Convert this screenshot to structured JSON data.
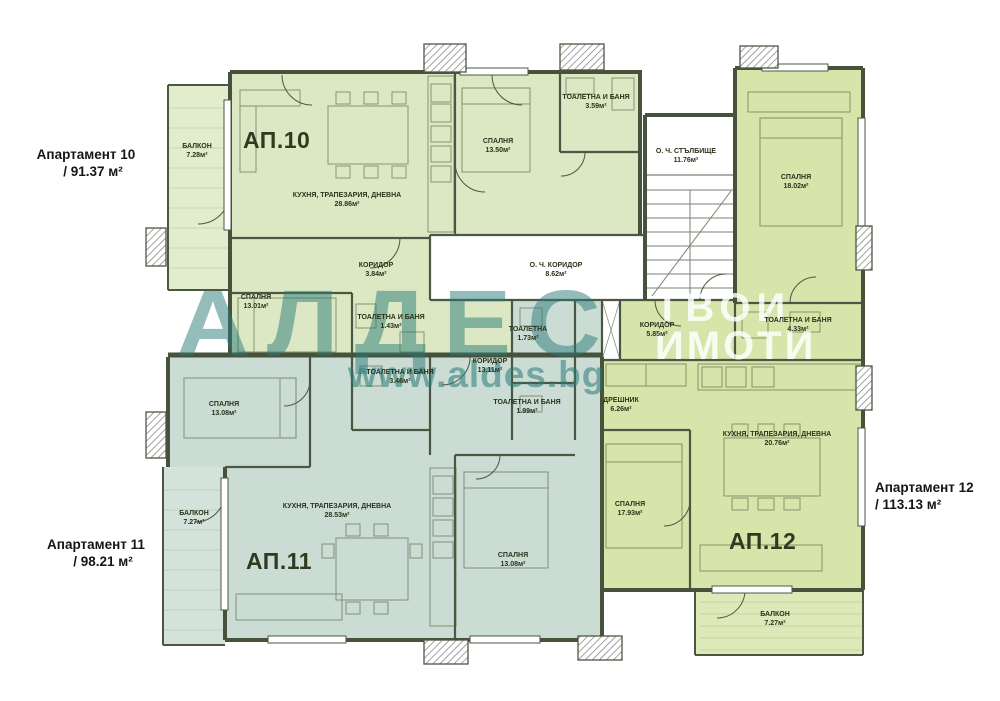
{
  "brand": {
    "logo_text": "АЛДЕС",
    "website": "www.aldes.bg",
    "tagline_line1": "ТВОИ",
    "tagline_line2": "ИМОТИ",
    "teal": "#2a7a78"
  },
  "apartments": [
    {
      "id": "ap10",
      "label": "Апартамент 10",
      "area": "/ 91.37 м²",
      "plan_label": "АП.10",
      "color": "#dbe8c3"
    },
    {
      "id": "ap11",
      "label": "Апартамент 11",
      "area": "/ 98.21 м²",
      "plan_label": "АП.11",
      "color": "#cbdcd4"
    },
    {
      "id": "ap12",
      "label": "Апартамент 12",
      "area": "/ 113.13 м²",
      "plan_label": "АП.12",
      "color": "#d7e5ab"
    }
  ],
  "rooms": [
    {
      "id": "balkon10",
      "apartment": "ap10",
      "name": "БАЛКОН",
      "area": "7.28м²"
    },
    {
      "id": "kitchen10",
      "apartment": "ap10",
      "name": "КУХНЯ, ТРАПЕЗАРИЯ, ДНЕВНА",
      "area": "28.86м²"
    },
    {
      "id": "koridor10",
      "apartment": "ap10",
      "name": "КОРИДОР",
      "area": "3.84м²"
    },
    {
      "id": "bedroom10a",
      "apartment": "ap10",
      "name": "СПАЛНЯ",
      "area": "13.50м²"
    },
    {
      "id": "bath10a",
      "apartment": "ap10",
      "name": "ТОАЛЕТНА И БАНЯ",
      "area": "3.59м²"
    },
    {
      "id": "bedroom10b",
      "apartment": "ap10",
      "name": "СПАЛНЯ",
      "area": "13.01м²"
    },
    {
      "id": "bath10b",
      "apartment": "ap10",
      "name": "ТОАЛЕТНА И БАНЯ",
      "area": "1.43м²"
    },
    {
      "id": "stairs",
      "apartment": "common",
      "name": "О. Ч. СТЪЛБИЩЕ",
      "area": "11.76м²"
    },
    {
      "id": "corridor_och",
      "apartment": "common",
      "name": "О. Ч. КОРИДОР",
      "area": "8.62м²"
    },
    {
      "id": "bedroom12a",
      "apartment": "ap12",
      "name": "СПАЛНЯ",
      "area": "18.02м²"
    },
    {
      "id": "bath12",
      "apartment": "ap12",
      "name": "ТОАЛЕТНА И БАНЯ",
      "area": "4.33м²"
    },
    {
      "id": "koridor12",
      "apartment": "ap12",
      "name": "КОРИДОР",
      "area": "5.85м²"
    },
    {
      "id": "dreshnik",
      "apartment": "ap12",
      "name": "ДРЕШНИК",
      "area": "6.26м²"
    },
    {
      "id": "kitchen12",
      "apartment": "ap12",
      "name": "КУХНЯ, ТРАПЕЗАРИЯ, ДНЕВНА",
      "area": "20.76м²"
    },
    {
      "id": "bedroom12b",
      "apartment": "ap12",
      "name": "СПАЛНЯ",
      "area": "17.93м²"
    },
    {
      "id": "balkon12",
      "apartment": "ap12",
      "name": "БАЛКОН",
      "area": "7.27м²"
    },
    {
      "id": "bedroom11a",
      "apartment": "ap11",
      "name": "СПАЛНЯ",
      "area": "13.08м²"
    },
    {
      "id": "balkon11",
      "apartment": "ap11",
      "name": "БАЛКОН",
      "area": "7.27м²"
    },
    {
      "id": "kitchen11",
      "apartment": "ap11",
      "name": "КУХНЯ, ТРАПЕЗАРИЯ, ДНЕВНА",
      "area": "28.53м²"
    },
    {
      "id": "bedroom11b",
      "apartment": "ap11",
      "name": "СПАЛНЯ",
      "area": "13.08м²"
    },
    {
      "id": "toilet11",
      "apartment": "ap11",
      "name": "ТОАЛЕТНА",
      "area": "1.73м²"
    },
    {
      "id": "koridor11",
      "apartment": "ap11",
      "name": "КОРИДОР",
      "area": "13.11м²"
    },
    {
      "id": "bath11a",
      "apartment": "ap11",
      "name": "ТОАЛЕТНА И БАНЯ",
      "area": "3.46м²"
    },
    {
      "id": "bath11b",
      "apartment": "ap11",
      "name": "ТОАЛЕТНА И БАНЯ",
      "area": "1.99м²"
    }
  ]
}
